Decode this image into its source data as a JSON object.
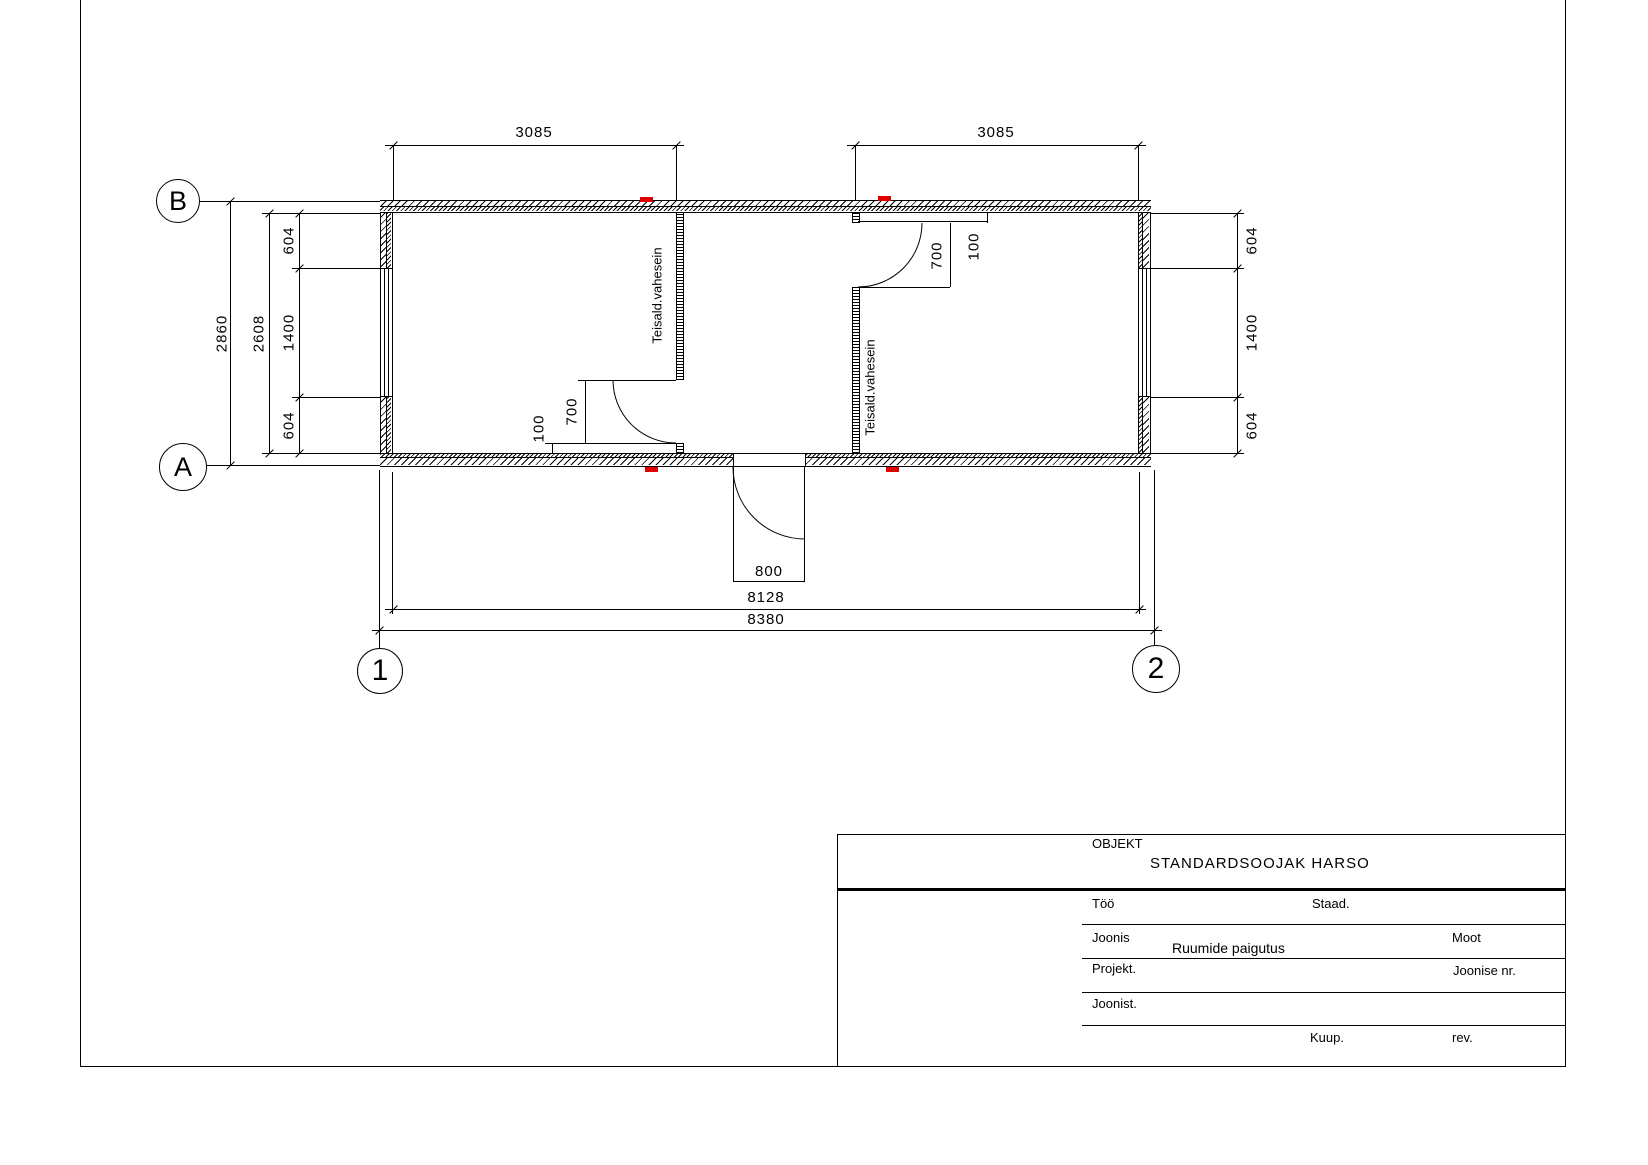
{
  "sheet": {
    "line_color": "#000000",
    "red_mark_color": "#e00000",
    "background": "#ffffff"
  },
  "grid": {
    "row_b": "B",
    "row_a": "A",
    "col_1": "1",
    "col_2": "2"
  },
  "dimensions": {
    "room_left_width": "3085",
    "room_right_width": "3085",
    "overall_height": "2860",
    "inner_height": "2608",
    "left_top": "604",
    "left_mid": "1400",
    "left_bot": "604",
    "right_top": "604",
    "right_mid": "1400",
    "right_bot": "604",
    "door_left_width": "700",
    "door_left_offset": "100",
    "door_right_width": "700",
    "door_right_offset": "100",
    "entry_door_width": "800",
    "inner_width": "8128",
    "overall_width": "8380"
  },
  "annotations": {
    "partition_left": "Teisald.vahesein",
    "partition_right": "Teisald.vahesein"
  },
  "title_block": {
    "objekt_label": "OBJEKT",
    "objekt_value": "STANDARDSOOJAK HARSO",
    "too_label": "Töö",
    "staad_label": "Staad.",
    "joonis_label": "Joonis",
    "joonis_value": "Ruumide paigutus",
    "moot_label": "Moot",
    "projekt_label": "Projekt.",
    "joonise_nr_label": "Joonise nr.",
    "joonist_label": "Joonist.",
    "kuup_label": "Kuup.",
    "rev_label": "rev."
  }
}
